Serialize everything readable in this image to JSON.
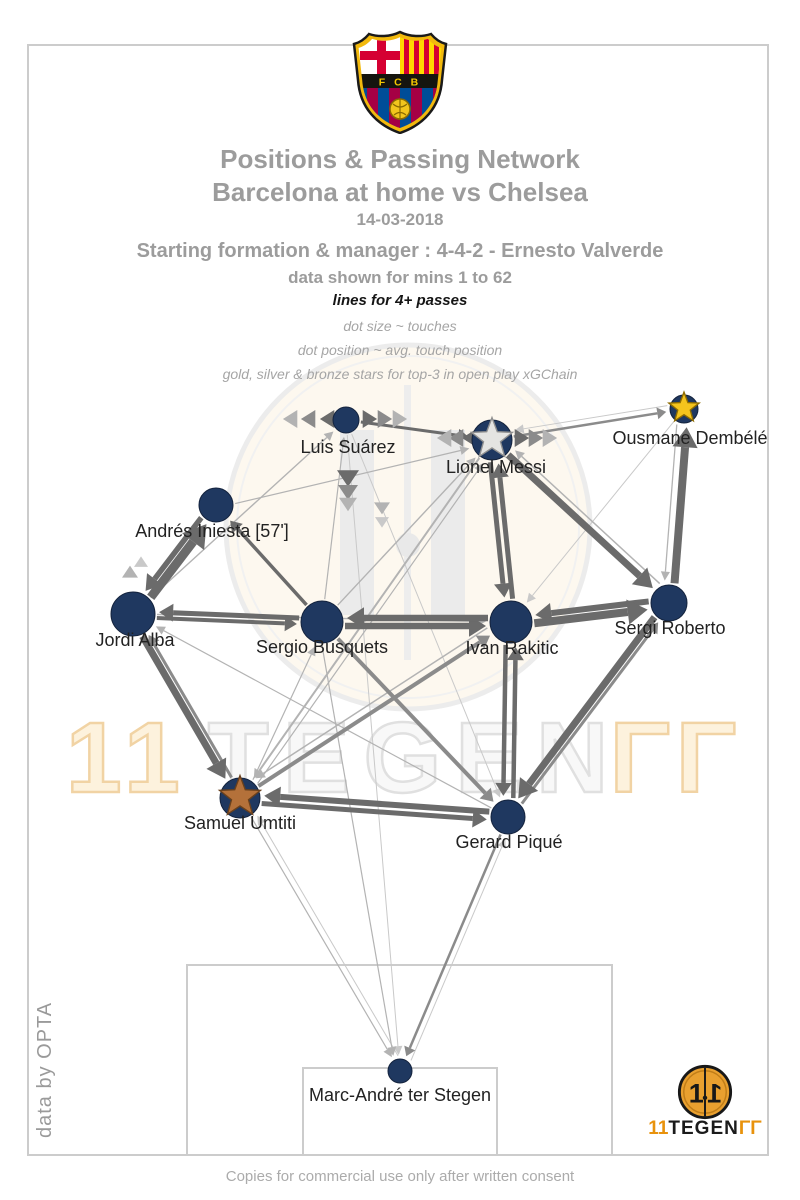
{
  "header": {
    "crest_text": "F C B",
    "title_line1": "Positions & Passing Network",
    "title_line2": "Barcelona at home vs Chelsea",
    "date": "14-03-2018",
    "formation_line": "Starting formation & manager : 4-4-2 - Ernesto Valverde",
    "mins_line": "data shown for mins 1 to 62",
    "lines_note": "lines for 4+ passes",
    "dot_size_note": "dot size ~ touches",
    "dot_pos_note": "dot position ~ avg. touch position",
    "stars_note": "gold, silver & bronze stars for top-3 in open play xGChain"
  },
  "footer": {
    "caption": "Copies for commercial use only after written consent",
    "credit": "data by OPTA",
    "logo_text": {
      "left": "11",
      "mid": "TEGEN",
      "right": "ΓΓ"
    }
  },
  "watermark": {
    "left": "11",
    "mid": "TEGEN",
    "right": "ΓΓ"
  },
  "colors": {
    "node": "#1f3860",
    "node_edge": "#14233d",
    "pitch_line": "#cccccc",
    "edge_dark": "#6b6b6b",
    "edge_mid": "#8b8b8b",
    "edge_light": "#b3b3b3",
    "edge_xlight": "#c9c9c9",
    "label": "#222222",
    "gold": "#f4c41d",
    "silver": "#e4e4e2",
    "bronze": "#b4713a"
  },
  "chart_data": {
    "type": "network",
    "title": "Positions & Passing Network — Barcelona at home vs Chelsea, 14-03-2018",
    "notes": {
      "edges": "lines for 4+ passes, width ~ pass volume",
      "dot_size": "touches",
      "dot_position": "avg. touch position",
      "stars": "gold, silver & bronze for top-3 open play xGChain"
    },
    "meta": {
      "team": "Barcelona",
      "opponent": "Chelsea",
      "venue": "home",
      "date": "14-03-2018",
      "formation": "4-4-2",
      "manager": "Ernesto Valverde",
      "minutes_shown": "1 to 62",
      "xgchain_top3": {
        "gold": "Ousmane Dembélé",
        "silver": "Lionel Messi",
        "bronze": "Samuel Umtiti"
      }
    },
    "pitch": {
      "outer": {
        "x": 28,
        "y": 45,
        "w": 740,
        "h": 1110
      },
      "crest_box": {
        "x": 303,
        "y": 45,
        "w": 194,
        "h": 84
      },
      "pen_box_btm": {
        "x": 187,
        "y": 965,
        "w": 425,
        "h": 190
      },
      "goal_box_btm": {
        "x": 303,
        "y": 1068,
        "w": 194,
        "h": 87
      }
    },
    "nodes": [
      {
        "id": "terstegen",
        "label": "Marc-André ter Stegen",
        "x": 400,
        "y": 1071,
        "r": 12,
        "star": null,
        "lx": 400,
        "ly": 1101
      },
      {
        "id": "umtiti",
        "label": "Samuel Umtiti",
        "x": 240,
        "y": 798,
        "r": 20,
        "star": "bronze",
        "lx": 240,
        "ly": 829
      },
      {
        "id": "pique",
        "label": "Gerard Piqué",
        "x": 508,
        "y": 817,
        "r": 17,
        "star": null,
        "lx": 509,
        "ly": 848
      },
      {
        "id": "alba",
        "label": "Jordi Alba",
        "x": 133,
        "y": 614,
        "r": 22,
        "star": null,
        "lx": 135,
        "ly": 646
      },
      {
        "id": "roberto",
        "label": "Sergi Roberto",
        "x": 669,
        "y": 603,
        "r": 18,
        "star": null,
        "lx": 670,
        "ly": 634
      },
      {
        "id": "busquets",
        "label": "Sergio Busquets",
        "x": 322,
        "y": 622,
        "r": 21,
        "star": null,
        "lx": 322,
        "ly": 653
      },
      {
        "id": "rakitic",
        "label": "Ivan Rakitic",
        "x": 511,
        "y": 622,
        "r": 21,
        "star": null,
        "lx": 512,
        "ly": 654
      },
      {
        "id": "iniesta",
        "label": "Andrés Iniesta [57']",
        "x": 216,
        "y": 505,
        "r": 17,
        "star": null,
        "lx": 212,
        "ly": 537
      },
      {
        "id": "suarez",
        "label": "Luis Suárez",
        "x": 346,
        "y": 420,
        "r": 13,
        "star": null,
        "lx": 348,
        "ly": 453
      },
      {
        "id": "messi",
        "label": "Lionel Messi",
        "x": 492,
        "y": 440,
        "r": 20,
        "star": "silver",
        "lx": 496,
        "ly": 473
      },
      {
        "id": "dembele",
        "label": "Ousmane Dembélé",
        "x": 684,
        "y": 409,
        "r": 14,
        "star": "gold",
        "lx": 690,
        "ly": 444
      }
    ],
    "edges": [
      {
        "f": "alba",
        "t": "iniesta",
        "w": 9,
        "c": "dark",
        "o": 4
      },
      {
        "f": "iniesta",
        "t": "alba",
        "w": 5.5,
        "c": "dark",
        "o": 4
      },
      {
        "f": "alba",
        "t": "umtiti",
        "w": 7,
        "c": "dark",
        "o": 3
      },
      {
        "f": "umtiti",
        "t": "alba",
        "w": 3,
        "c": "mid",
        "o": 3
      },
      {
        "f": "busquets",
        "t": "alba",
        "w": 5,
        "c": "dark",
        "o": 3
      },
      {
        "f": "alba",
        "t": "busquets",
        "w": 4,
        "c": "dark",
        "o": 3
      },
      {
        "f": "busquets",
        "t": "rakitic",
        "w": 6.5,
        "c": "dark",
        "o": 4
      },
      {
        "f": "rakitic",
        "t": "busquets",
        "w": 6.5,
        "c": "dark",
        "o": 4
      },
      {
        "f": "rakitic",
        "t": "roberto",
        "w": 8,
        "c": "dark",
        "o": 4
      },
      {
        "f": "roberto",
        "t": "rakitic",
        "w": 6,
        "c": "dark",
        "o": 4
      },
      {
        "f": "messi",
        "t": "rakitic",
        "w": 5,
        "c": "dark",
        "o": 4
      },
      {
        "f": "rakitic",
        "t": "messi",
        "w": 5,
        "c": "dark",
        "o": 4
      },
      {
        "f": "roberto",
        "t": "dembele",
        "w": 8,
        "c": "dark",
        "o": 4
      },
      {
        "f": "dembele",
        "t": "roberto",
        "w": 1.3,
        "c": "light",
        "o": 6
      },
      {
        "f": "messi",
        "t": "roberto",
        "w": 7,
        "c": "dark",
        "o": 0
      },
      {
        "f": "roberto",
        "t": "messi",
        "w": 1.5,
        "c": "light",
        "o": 8
      },
      {
        "f": "roberto",
        "t": "pique",
        "w": 7,
        "c": "dark",
        "o": 3
      },
      {
        "f": "pique",
        "t": "roberto",
        "w": 3,
        "c": "mid",
        "o": 3
      },
      {
        "f": "rakitic",
        "t": "pique",
        "w": 4.5,
        "c": "dark",
        "o": 5
      },
      {
        "f": "pique",
        "t": "rakitic",
        "w": 4.5,
        "c": "dark",
        "o": 5
      },
      {
        "f": "pique",
        "t": "umtiti",
        "w": 6,
        "c": "dark",
        "o": 4
      },
      {
        "f": "umtiti",
        "t": "pique",
        "w": 5,
        "c": "dark",
        "o": 4
      },
      {
        "f": "busquets",
        "t": "pique",
        "w": 4,
        "c": "mid",
        "o": 0
      },
      {
        "f": "umtiti",
        "t": "rakitic",
        "w": 4,
        "c": "mid",
        "o": 0
      },
      {
        "f": "rakitic",
        "t": "umtiti",
        "w": 1.5,
        "c": "light",
        "o": 8
      },
      {
        "f": "messi",
        "t": "umtiti",
        "w": 2,
        "c": "light",
        "o": 0
      },
      {
        "f": "suarez",
        "t": "messi",
        "w": 3,
        "c": "dark",
        "o": 0
      },
      {
        "f": "busquets",
        "t": "iniesta",
        "w": 3.5,
        "c": "dark",
        "o": 0
      },
      {
        "f": "messi",
        "t": "dembele",
        "w": 2.5,
        "c": "mid",
        "o": 0
      },
      {
        "f": "dembele",
        "t": "messi",
        "w": 1,
        "c": "xlight",
        "o": 6
      },
      {
        "f": "pique",
        "t": "terstegen",
        "w": 2.5,
        "c": "mid",
        "o": 0
      },
      {
        "f": "umtiti",
        "t": "terstegen",
        "w": 1.2,
        "c": "light",
        "o": 0
      },
      {
        "f": "busquets",
        "t": "terstegen",
        "w": 1.2,
        "c": "light",
        "o": 4
      },
      {
        "f": "suarez",
        "t": "terstegen",
        "w": 1,
        "c": "xlight",
        "o": 0
      },
      {
        "f": "terstegen",
        "t": "pique",
        "w": 1,
        "c": "xlight",
        "o": 6
      },
      {
        "f": "terstegen",
        "t": "umtiti",
        "w": 1,
        "c": "xlight",
        "o": 6
      },
      {
        "f": "alba",
        "t": "suarez",
        "w": 1.4,
        "c": "light",
        "o": 0
      },
      {
        "f": "busquets",
        "t": "suarez",
        "w": 1.2,
        "c": "light",
        "o": 0
      },
      {
        "f": "busquets",
        "t": "messi",
        "w": 1.4,
        "c": "light",
        "o": 0
      },
      {
        "f": "iniesta",
        "t": "messi",
        "w": 1.2,
        "c": "light",
        "o": 3
      },
      {
        "f": "umtiti",
        "t": "messi",
        "w": 1.2,
        "c": "light",
        "o": 6
      },
      {
        "f": "alba",
        "t": "rakitic",
        "w": 1.4,
        "c": "light",
        "o": 0
      },
      {
        "f": "umtiti",
        "t": "busquets",
        "w": 1.2,
        "c": "light",
        "o": 4
      },
      {
        "f": "dembele",
        "t": "rakitic",
        "w": 1,
        "c": "xlight",
        "o": 0
      },
      {
        "f": "suarez",
        "t": "pique",
        "w": 1,
        "c": "xlight",
        "o": 0
      },
      {
        "f": "pique",
        "t": "alba",
        "w": 1.2,
        "c": "light",
        "o": 0
      }
    ],
    "chevrons": [
      {
        "x": 328,
        "y": 419,
        "dir": "left",
        "c": "dark",
        "s": 9
      },
      {
        "x": 309,
        "y": 419,
        "dir": "left",
        "c": "mid",
        "s": 9
      },
      {
        "x": 291,
        "y": 419,
        "dir": "left",
        "c": "light",
        "s": 9
      },
      {
        "x": 369,
        "y": 419,
        "dir": "right",
        "c": "dark",
        "s": 9
      },
      {
        "x": 384,
        "y": 419,
        "dir": "right",
        "c": "mid",
        "s": 9
      },
      {
        "x": 399,
        "y": 419,
        "dir": "right",
        "c": "light",
        "s": 9
      },
      {
        "x": 348,
        "y": 478,
        "dir": "down",
        "c": "dark",
        "s": 11
      },
      {
        "x": 348,
        "y": 492,
        "dir": "down",
        "c": "mid",
        "s": 10
      },
      {
        "x": 348,
        "y": 504,
        "dir": "down",
        "c": "light",
        "s": 9
      },
      {
        "x": 470,
        "y": 438,
        "dir": "left",
        "c": "dark",
        "s": 9
      },
      {
        "x": 457,
        "y": 438,
        "dir": "left",
        "c": "mid",
        "s": 9
      },
      {
        "x": 445,
        "y": 438,
        "dir": "left",
        "c": "light",
        "s": 9
      },
      {
        "x": 521,
        "y": 438,
        "dir": "right",
        "c": "dark",
        "s": 9
      },
      {
        "x": 535,
        "y": 438,
        "dir": "right",
        "c": "mid",
        "s": 9
      },
      {
        "x": 549,
        "y": 438,
        "dir": "right",
        "c": "light",
        "s": 9
      },
      {
        "x": 130,
        "y": 572,
        "dir": "up",
        "c": "light",
        "s": 8
      },
      {
        "x": 141,
        "y": 562,
        "dir": "up",
        "c": "xlight",
        "s": 7
      },
      {
        "x": 382,
        "y": 508,
        "dir": "down",
        "c": "light",
        "s": 8
      },
      {
        "x": 382,
        "y": 522,
        "dir": "down",
        "c": "xlight",
        "s": 7
      }
    ]
  }
}
